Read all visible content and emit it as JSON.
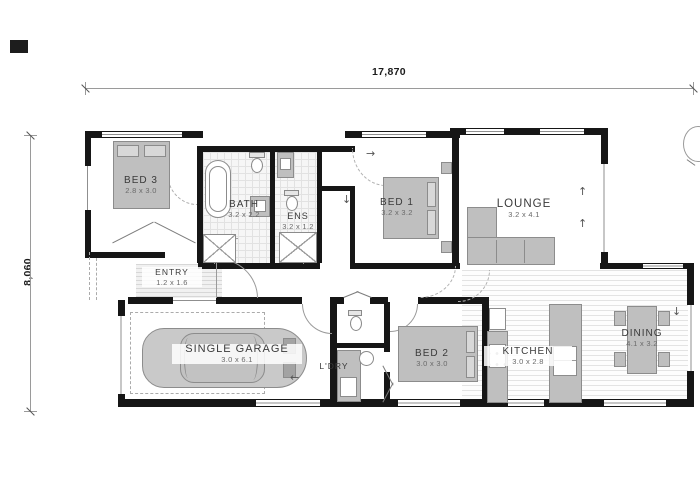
{
  "dimensions": {
    "overall_width": "17,870",
    "overall_depth": "8,060"
  },
  "rooms": [
    {
      "name": "BED 3",
      "size": "2.8 x 3.0"
    },
    {
      "name": "BATH",
      "size": "3.2 x 2.2"
    },
    {
      "name": "ENS",
      "size": "3.2 x 1.2"
    },
    {
      "name": "BED 1",
      "size": "3.2 x 3.2"
    },
    {
      "name": "LOUNGE",
      "size": "3.2 x 4.1"
    },
    {
      "name": "ENTRY",
      "size": "1.2 x 1.6"
    },
    {
      "name": "SINGLE GARAGE",
      "size": "3.0 x 6.1"
    },
    {
      "name": "L'DRY",
      "size": ""
    },
    {
      "name": "BED 2",
      "size": "3.0 x 3.0"
    },
    {
      "name": "KITCHEN",
      "size": "3.0 x 2.8"
    },
    {
      "name": "DINING",
      "size": "4.1 x 3.2"
    }
  ],
  "symbols": {
    "up": "↑",
    "down": "↓",
    "left": "←",
    "right": "→"
  }
}
